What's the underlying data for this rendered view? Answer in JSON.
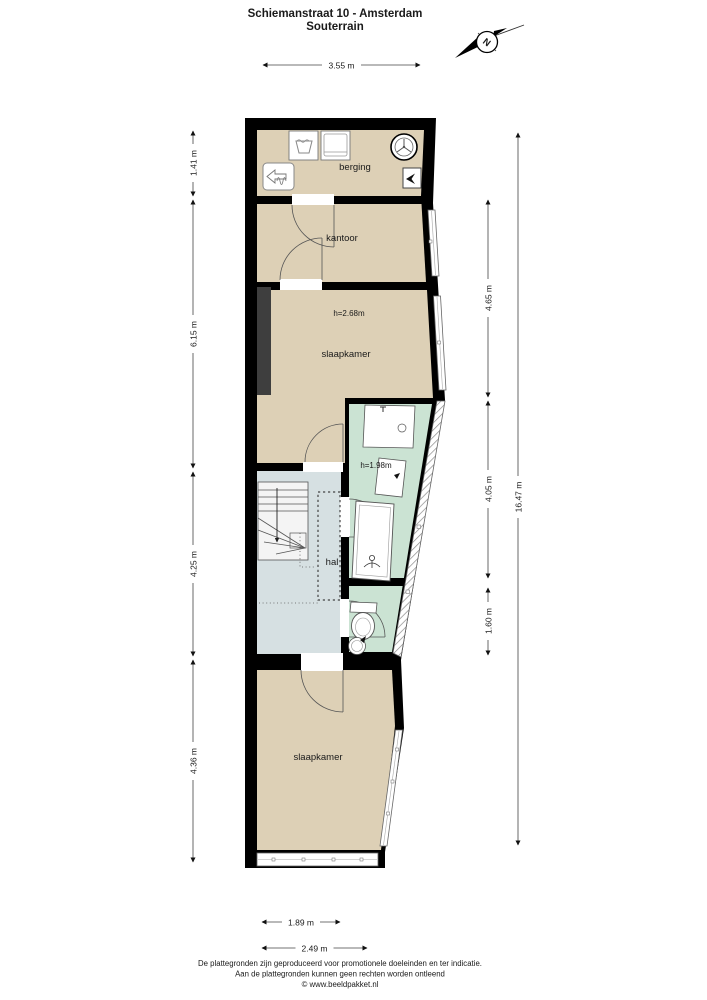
{
  "title": {
    "line1": "Schiemanstraat 10 - Amsterdam",
    "line2": "Souterrain"
  },
  "compass": {
    "north_label": "N"
  },
  "rooms": {
    "berging": {
      "label": "berging"
    },
    "kantoor": {
      "label": "kantoor"
    },
    "slaapkamer_top": {
      "label": "slaapkamer",
      "height": "h=2.68m"
    },
    "badkamer": {
      "height": "h=1.98m"
    },
    "hal": {
      "label": "hal"
    },
    "slaapkamer_bottom": {
      "label": "slaapkamer"
    }
  },
  "dimensions": {
    "top_width": "3.55 m",
    "left": [
      "1.41 m",
      "6.15 m",
      "4.25 m",
      "4.36 m"
    ],
    "right": [
      "4.65 m",
      "4.05 m",
      "1.60 m"
    ],
    "total_height": "16.47 m",
    "bottom": [
      "1.89 m",
      "2.49 m"
    ]
  },
  "footer": {
    "line1": "De plattegronden zijn geproduceerd voor promotionele doeleinden en ter indicatie.",
    "line2": "Aan de plattegronden kunnen geen rechten worden ontleend",
    "line3": "© www.beeldpakket.nl"
  },
  "colors": {
    "wall": "#000000",
    "floor": "#ddd0b6",
    "bathroom": "#cbe3d3",
    "hall": "#d6e0e2",
    "chimney": "#3e3e3e"
  }
}
